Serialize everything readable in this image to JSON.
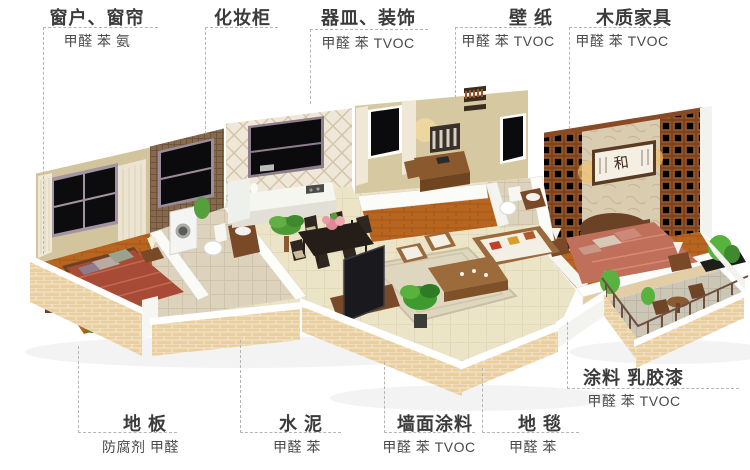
{
  "labels": {
    "top": [
      {
        "title": "窗户、窗帘",
        "pollutants": "甲醛 苯 氨"
      },
      {
        "title": "化妆柜",
        "pollutants": ""
      },
      {
        "title": "器皿、装饰",
        "pollutants": "甲醛 苯 TVOC"
      },
      {
        "title": "壁 纸",
        "pollutants": "甲醛 苯 TVOC"
      },
      {
        "title": "木质家具",
        "pollutants": "甲醛 苯 TVOC"
      }
    ],
    "right": {
      "title": "涂料 乳胶漆",
      "pollutants": "甲醛 苯 TVOC"
    },
    "bottom": [
      {
        "title": "地 板",
        "pollutants": "防腐剂 甲醛"
      },
      {
        "title": "水 泥",
        "pollutants": "甲醛 苯"
      },
      {
        "title": "墙面涂料",
        "pollutants": "甲醛 苯 TVOC"
      },
      {
        "title": "地 毯",
        "pollutants": "甲醛 苯"
      }
    ]
  },
  "illustration": {
    "wall_art_text": "和"
  },
  "colors": {
    "label_title": "#3b3b3b",
    "label_sub": "#4a4a4a",
    "dash_line": "#b5b5b5",
    "brick": "#e9cfa0",
    "bedroom_wall": "#d2c49c",
    "mosaic_wall": "#876a4e",
    "bed_red": "#a84b36",
    "master_bed_pink": "#c0705a",
    "wood_floor": "#b8651f",
    "lattice_panel": "#7d421e"
  }
}
